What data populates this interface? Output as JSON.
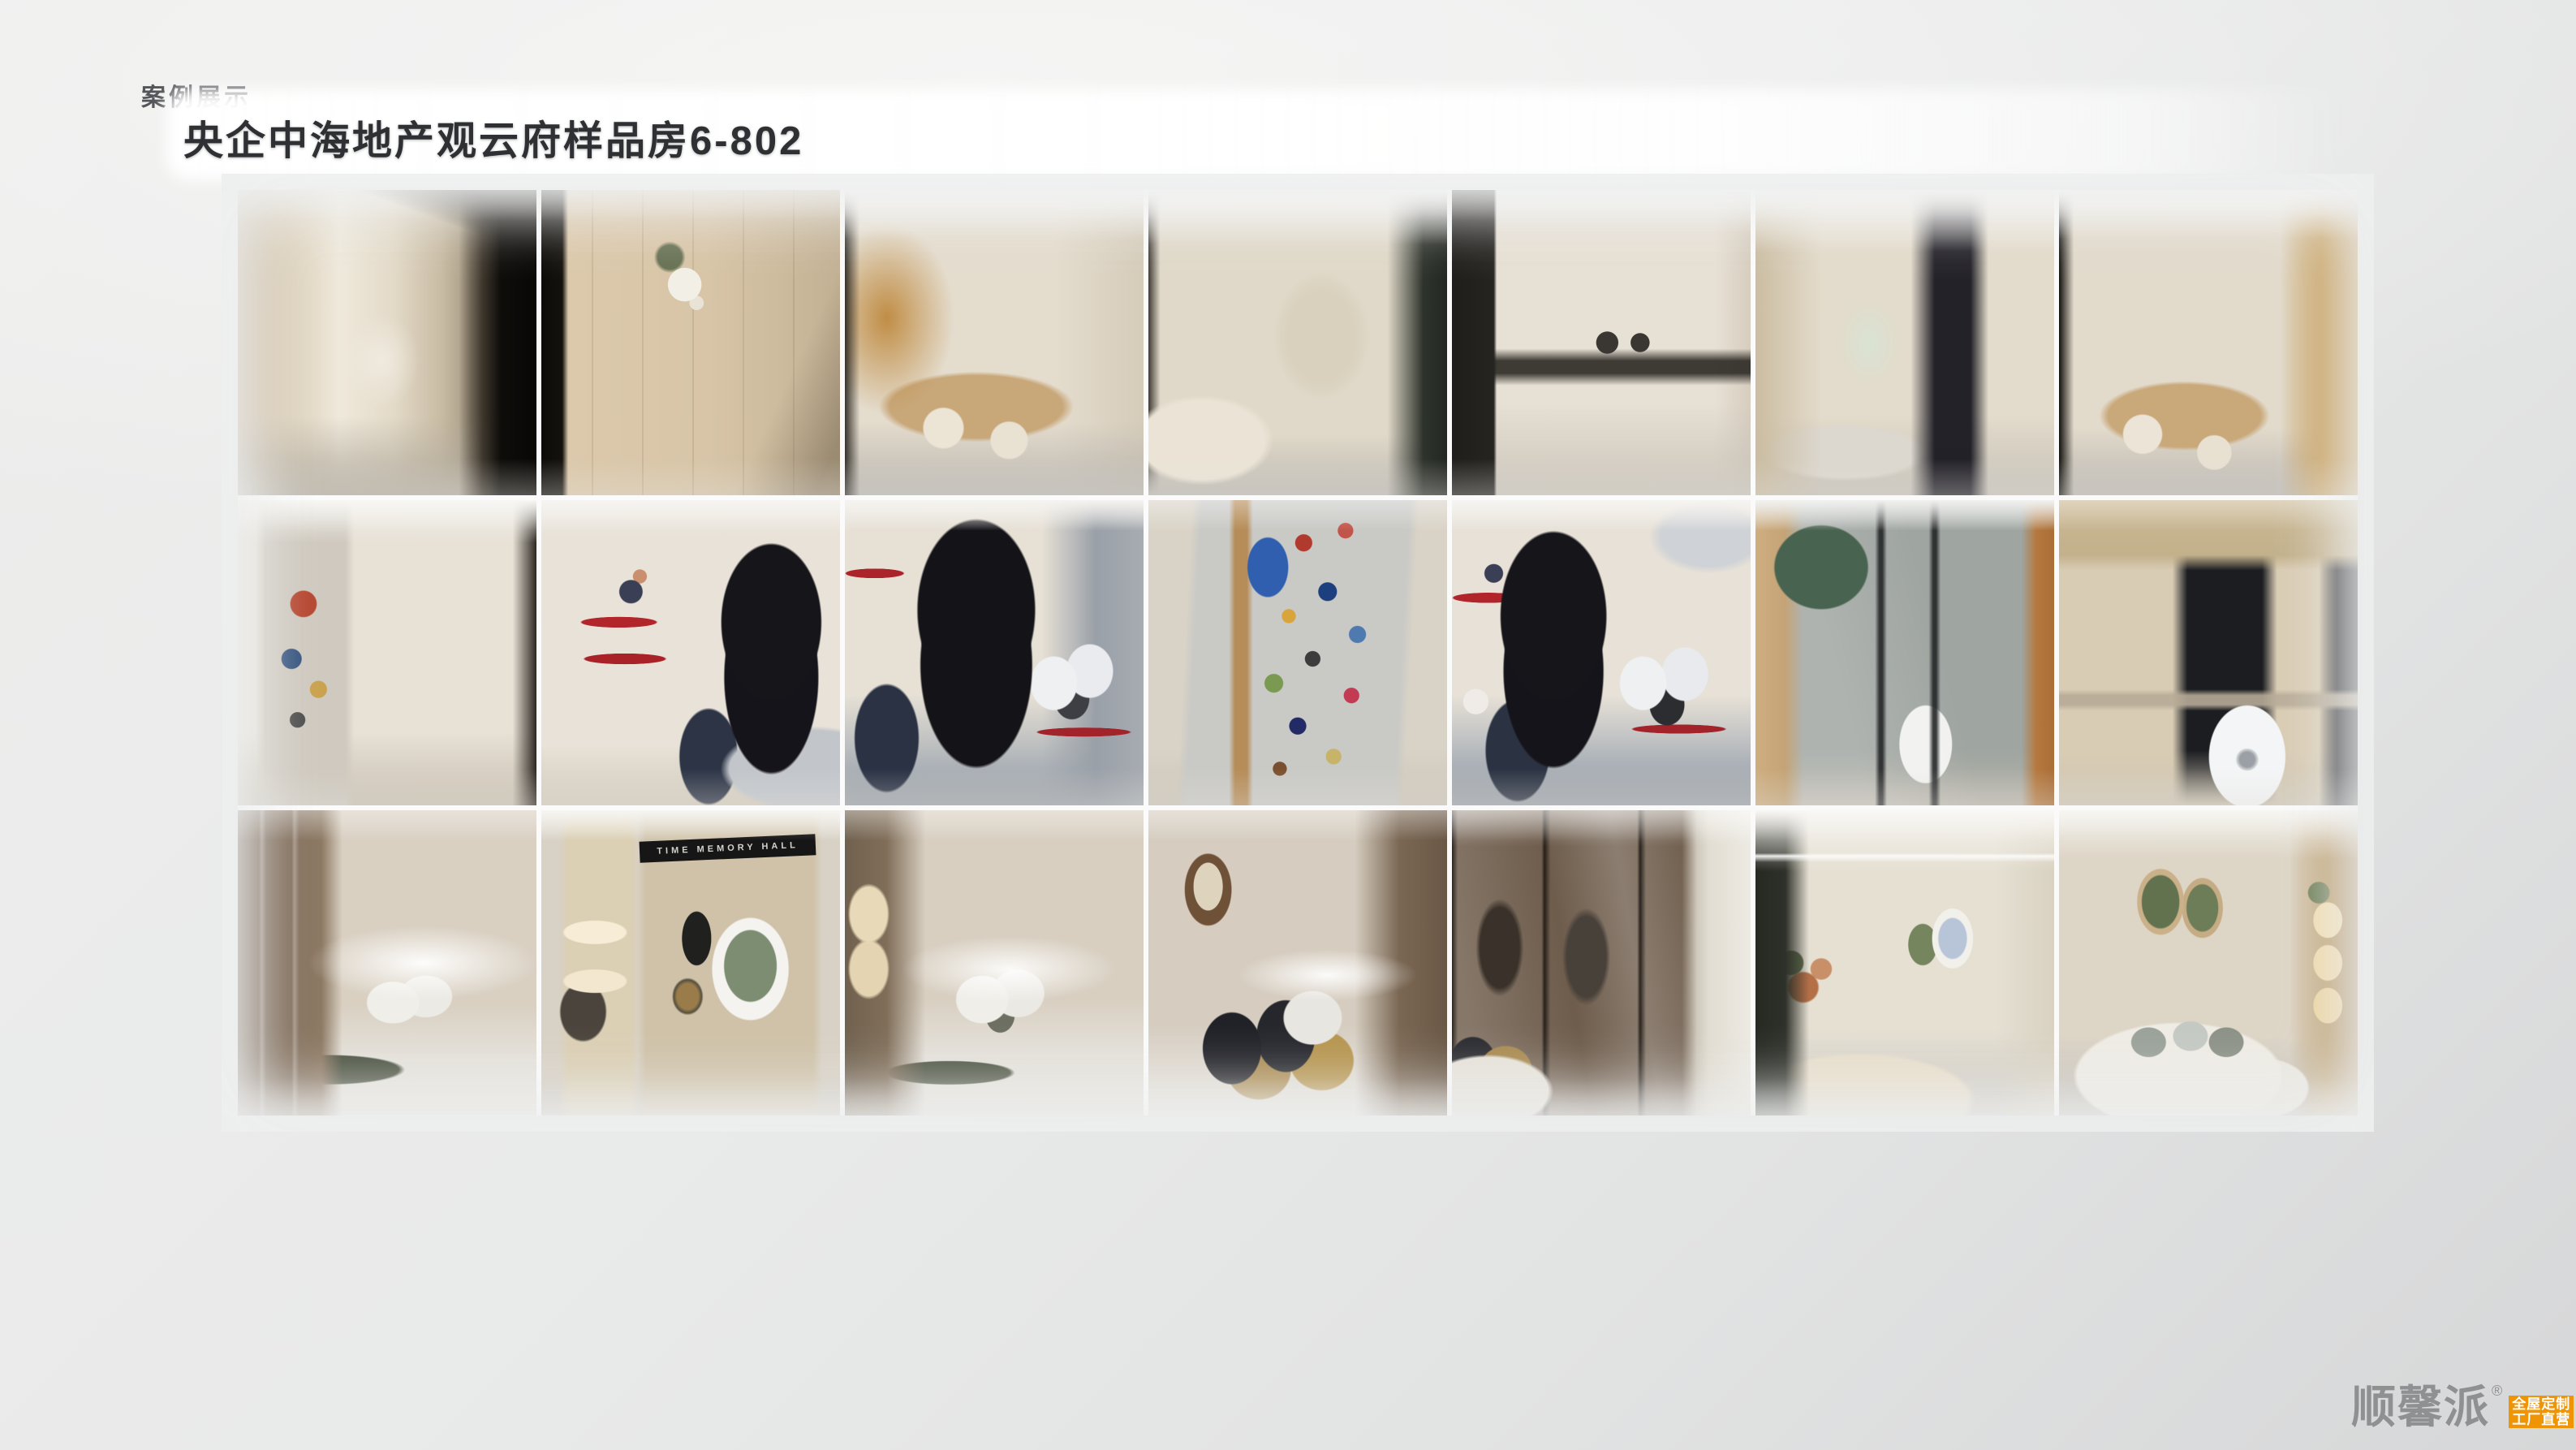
{
  "slide": {
    "section_label": "案例展示",
    "title": "央企中海地产观云府样品房6-802"
  },
  "gallery": {
    "rows": [
      [
        {
          "name": "photo-entry-hallway"
        },
        {
          "name": "photo-entry-door-panel"
        },
        {
          "name": "photo-dining-shelves"
        },
        {
          "name": "photo-living-room"
        },
        {
          "name": "photo-kitchen"
        },
        {
          "name": "photo-hallway-to-dining"
        },
        {
          "name": "photo-dining-table"
        }
      ],
      [
        {
          "name": "photo-corridor-artwork"
        },
        {
          "name": "photo-kids-room-red-shelves"
        },
        {
          "name": "photo-kids-room-bed"
        },
        {
          "name": "photo-photo-collage-wall"
        },
        {
          "name": "photo-kids-room-mirror"
        },
        {
          "name": "photo-bathroom"
        },
        {
          "name": "photo-balcony-laundry"
        }
      ],
      [
        {
          "name": "photo-master-bedroom-wardrobe"
        },
        {
          "name": "photo-memory-wall",
          "caption": "TIME MEMORY HALL"
        },
        {
          "name": "photo-master-bedroom-bed"
        },
        {
          "name": "photo-bed-pillows"
        },
        {
          "name": "photo-wardrobe-glass-doors"
        },
        {
          "name": "photo-living-dining-area"
        },
        {
          "name": "photo-living-room-sofa"
        }
      ]
    ]
  },
  "footer": {
    "brand_name": "顺馨派",
    "registered_mark": "®",
    "badge": {
      "line1": "全屋定制",
      "line2": "工厂直营"
    }
  },
  "colors": {
    "badge_orange": "#ef9405",
    "brand_gray": "#8f9091",
    "title_dark": "#2f3033",
    "section_label_gray": "#54555a",
    "background_gray": "#e8e9e9",
    "gallery_gap_white": "#fcfcfc"
  }
}
